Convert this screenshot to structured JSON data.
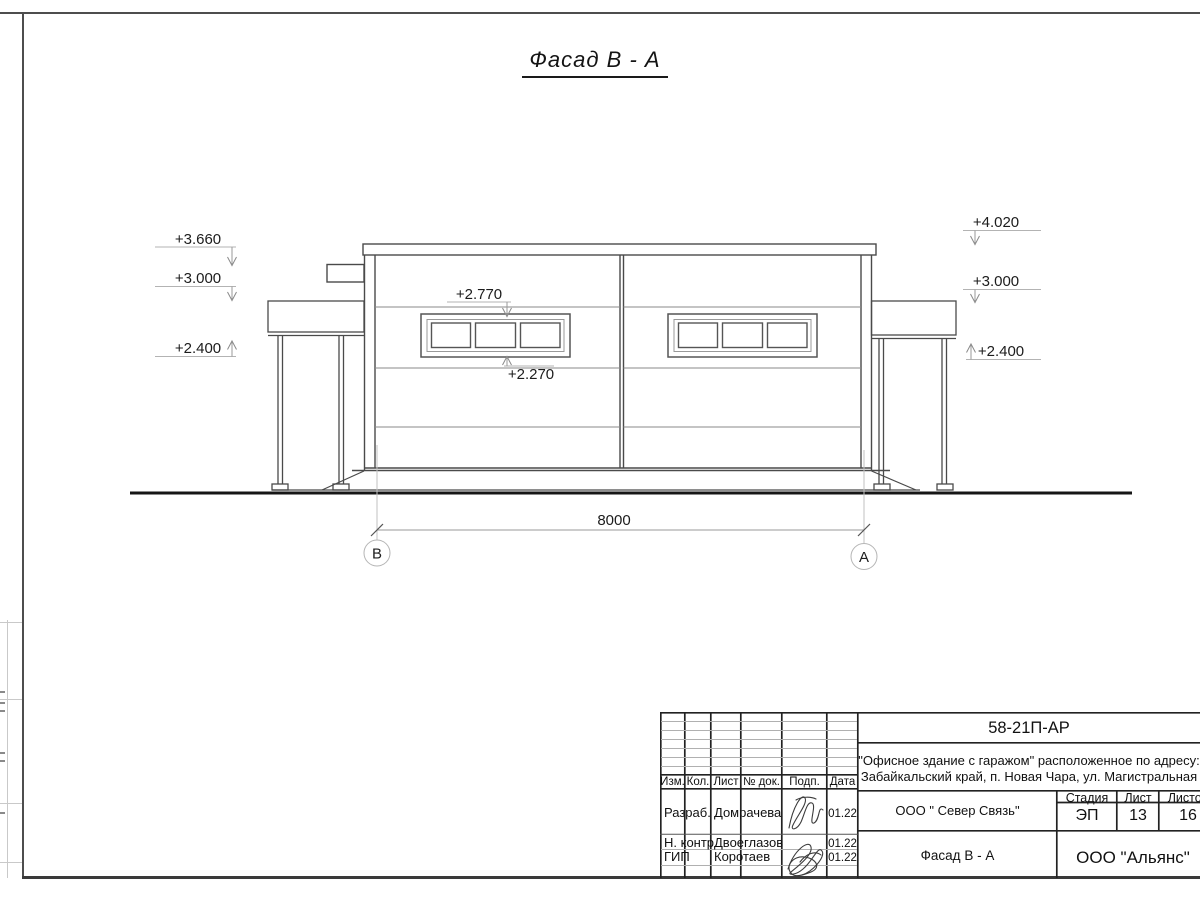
{
  "title": "Фасад В - А",
  "drawing": {
    "marks": {
      "left_top": "+3.660",
      "left_mid": "+3.000",
      "left_low": "+2.400",
      "right_top": "+4.020",
      "right_mid": "+3.000",
      "right_low": "+2.400",
      "window_top": "+2.770",
      "window_bottom": "+2.270"
    },
    "dimension_value": "8000",
    "axis_left": "В",
    "axis_right": "А"
  },
  "titleblock": {
    "doc_number": "58-21П-АР",
    "address_line1": "\"Офисное здание с гаражом\" расположенное по адресу:",
    "address_line2": "Забайкальский край, п. Новая Чара, ул. Магистральная",
    "header": {
      "izm": "Изм.",
      "kol": "Кол.",
      "list": "Лист",
      "ndok": "№ док.",
      "podp": "Подп.",
      "data": "Дата"
    },
    "rows": [
      {
        "role": "Разраб.",
        "name": "Домрачева",
        "date": "01.22"
      },
      {
        "role": "Н. контр.",
        "name": "Двоеглазов",
        "date": "01.22"
      },
      {
        "role": "ГИП",
        "name": "Коротаев",
        "date": "01.22"
      }
    ],
    "company": "ООО \" Север Связь\"",
    "stage_label": "Стадия",
    "sheet_label": "Лист",
    "sheets_label": "Листов",
    "stage_value": "ЭП",
    "sheet_value": "13",
    "sheets_value": "16",
    "drawing_name": "Фасад В - А",
    "org_name": "ООО \"Альянс\""
  },
  "colors": {
    "line_dark": "#4a4a4a",
    "line_light": "#8a8a8a",
    "ground": "#161616",
    "leader": "#b3b3b3"
  }
}
